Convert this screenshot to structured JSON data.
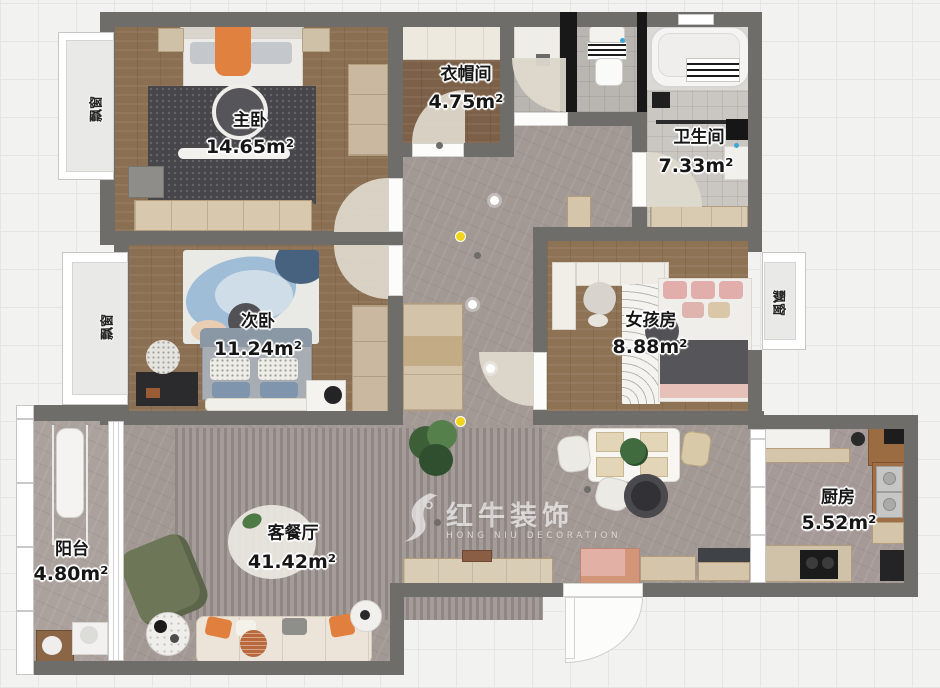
{
  "rooms": {
    "master_bedroom": {
      "name": "主卧",
      "area": "14.65m²"
    },
    "cloakroom": {
      "name": "衣帽间",
      "area": "4.75m²"
    },
    "bathroom": {
      "name": "卫生间",
      "area": "7.33m²"
    },
    "second_bedroom": {
      "name": "次卧",
      "area": "11.24m²"
    },
    "girls_room": {
      "name": "女孩房",
      "area": "8.88m²"
    },
    "living_dining": {
      "name": "客餐厅",
      "area": "41.42m²"
    },
    "balcony": {
      "name": "阳台",
      "area": "4.80m²"
    },
    "kitchen": {
      "name": "厨房",
      "area": "5.52m²"
    }
  },
  "labels": {
    "bay_window": "飘窗"
  },
  "watermark": {
    "brand_cn": "红牛装饰",
    "brand_en": "HONG NIU DECORATION"
  },
  "colors": {
    "wall": "#6f6d6a",
    "wood_floor": "#8a6f52",
    "stone_floor": "#a29894",
    "tile_floor": "#b9b6b2",
    "accent_orange": "#e07f3e",
    "accent_yellow": "#f2d41c",
    "dark_rug": "#48484c",
    "watermark_white": "#ffffff",
    "background": "#f2f2f0"
  }
}
